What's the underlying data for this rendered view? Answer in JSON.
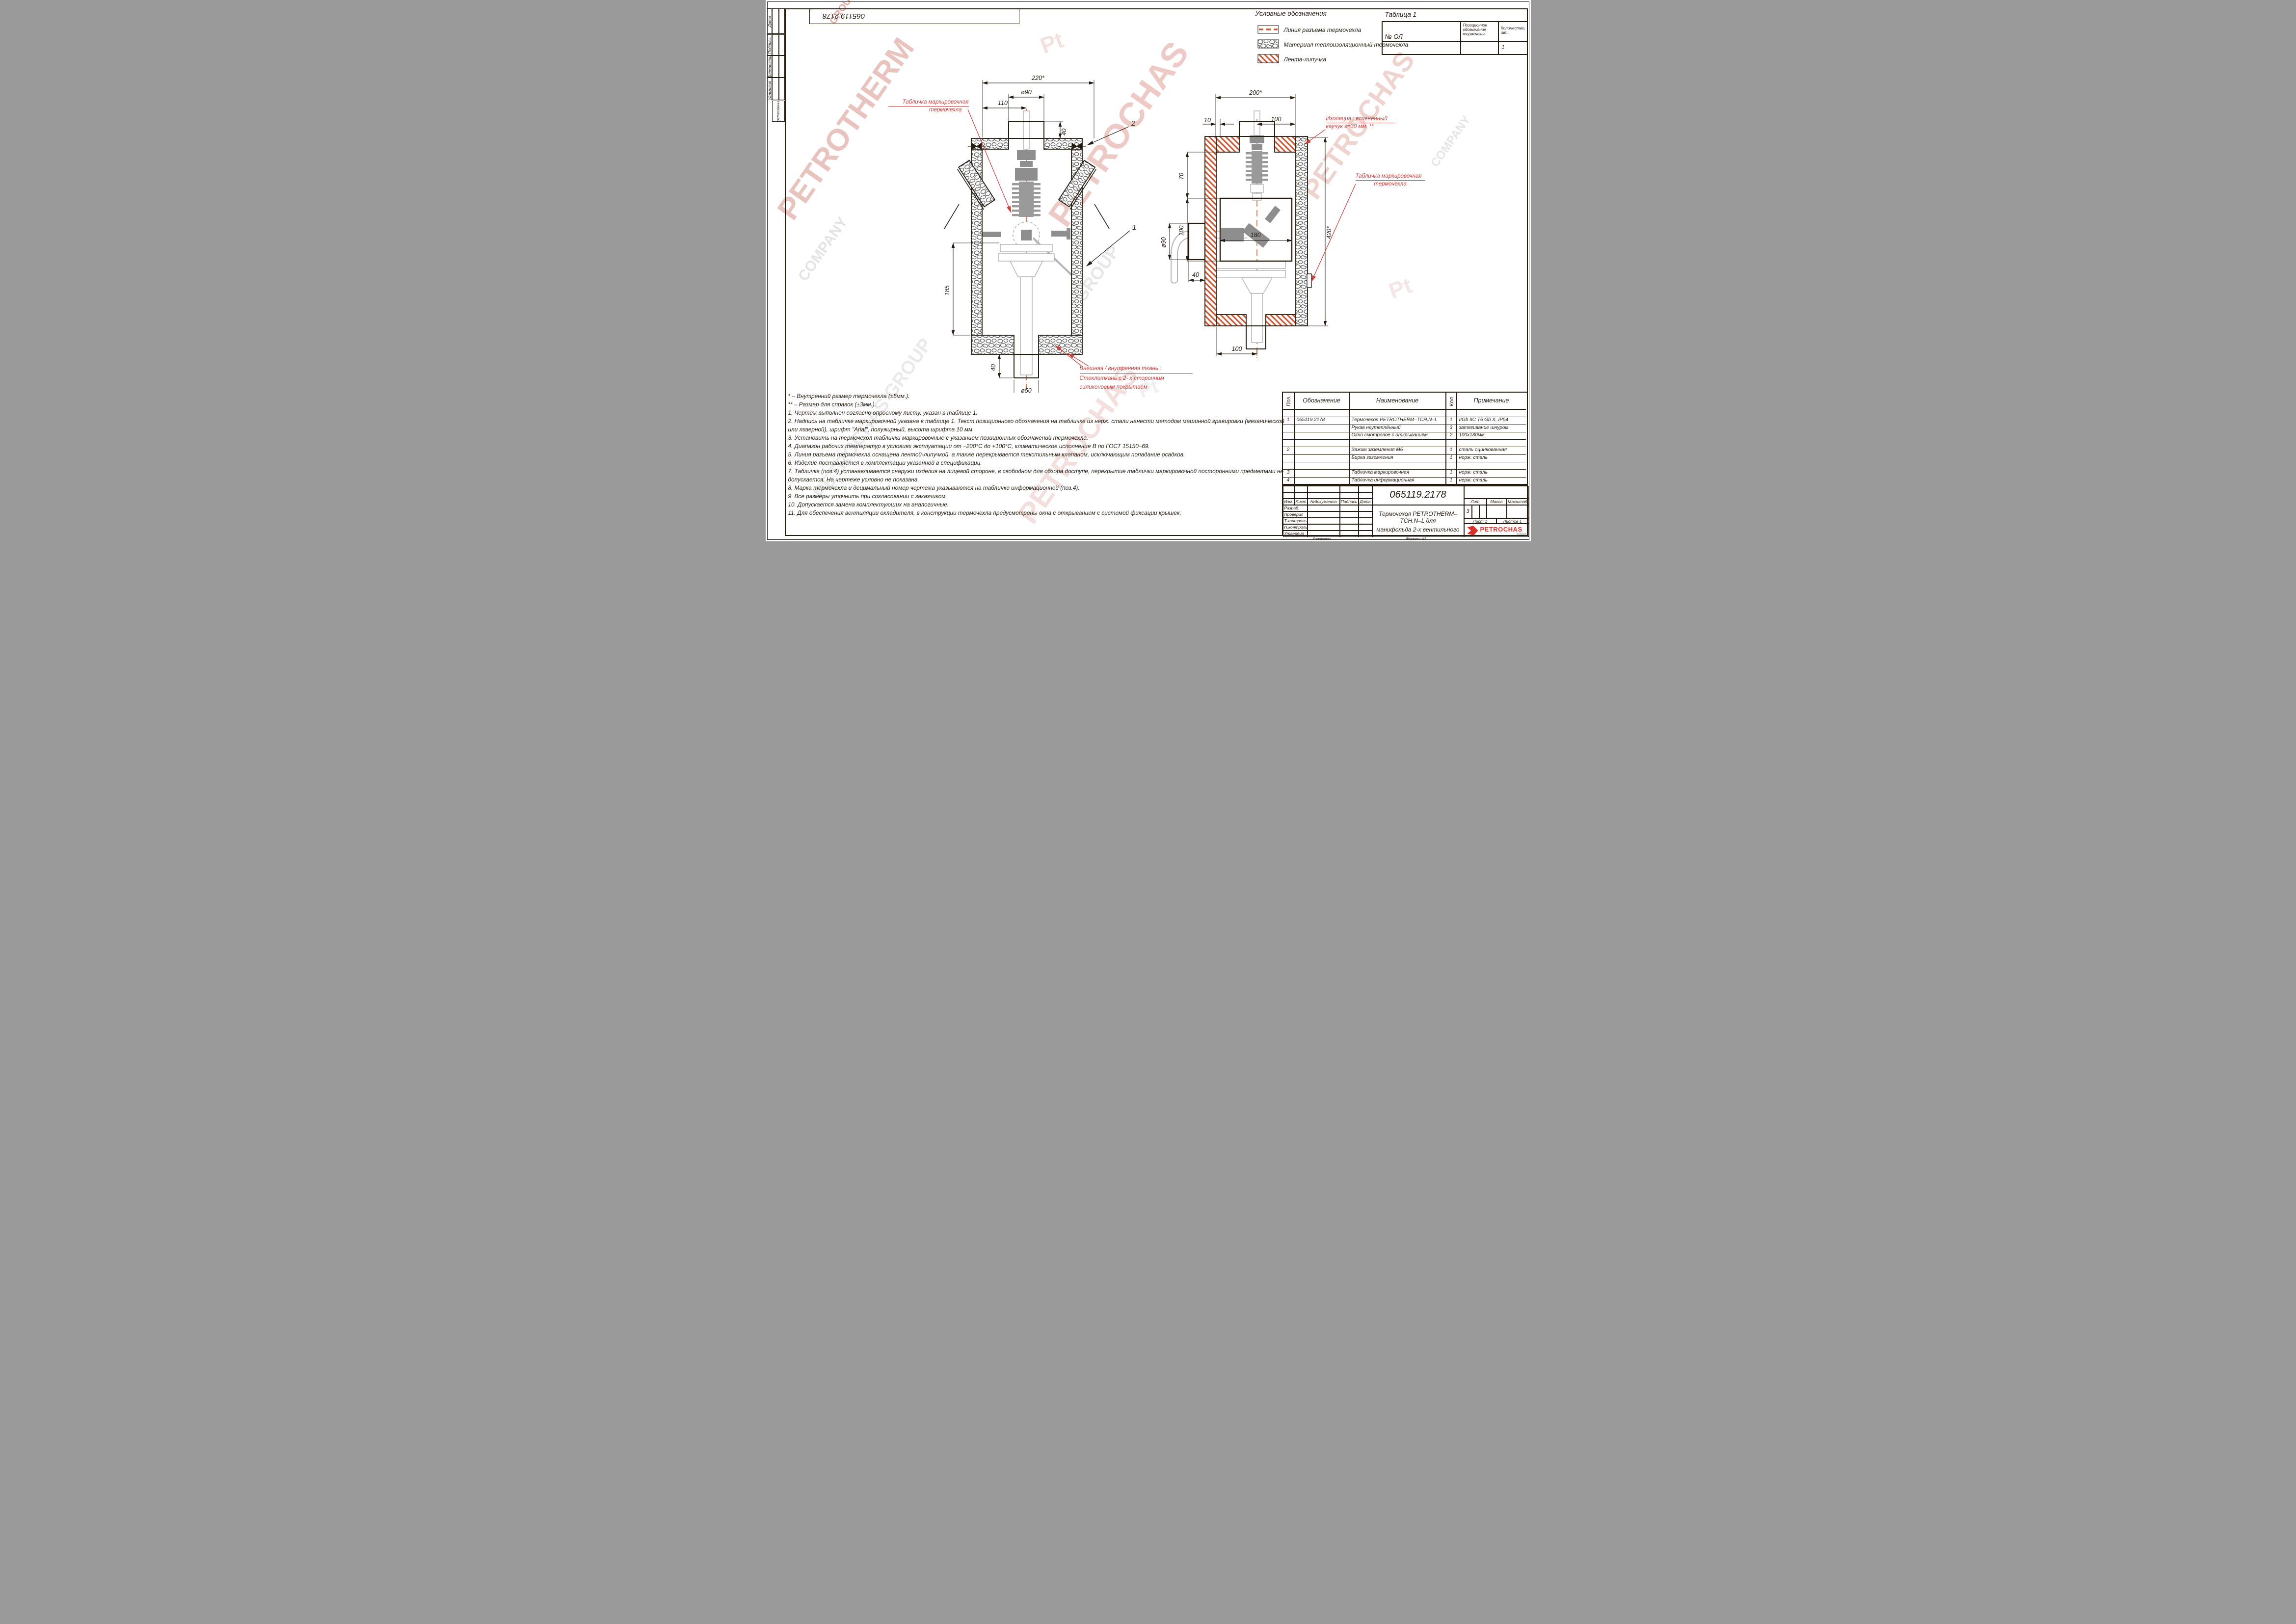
{
  "sheet": {
    "doc_number_top": "065119.2178",
    "copied_label": "Копировал",
    "format_label": "Формат А2"
  },
  "sidebar": {
    "labels": [
      "Дата",
      "Подпись",
      "Должность",
      "Фамилия",
      "Согласование"
    ]
  },
  "legend": {
    "title": "Условные обозначения",
    "items": [
      {
        "icon": "parting-line-swatch",
        "label": "Линия разъема термочехла"
      },
      {
        "icon": "insulation-swatch",
        "label": "Материал теплоизоляционный термочехла"
      },
      {
        "icon": "velcro-swatch",
        "label": "Лента-липучка"
      }
    ]
  },
  "table1": {
    "title": "Таблица 1",
    "col_ol": "№ ОЛ",
    "col_pos": [
      "Позиционное",
      "обозначение",
      "термочехла"
    ],
    "col_qty": [
      "Количество,",
      "шт."
    ],
    "row_qty": "1"
  },
  "left_view": {
    "dims": {
      "w220": "220*",
      "d90": "ø90",
      "w110": "110",
      "h40": "40",
      "h185": "185",
      "h40b": "40",
      "d50": "ø50"
    },
    "callout1": "1",
    "callout2": "2",
    "marking_label": [
      "Табличка маркировочная",
      "термочехла"
    ],
    "fabric_label": [
      "Внешняя / внутренняя ткань :",
      "Стеклоткань с  2- х сторонним",
      "силиконовым покрытием"
    ]
  },
  "right_view": {
    "dims": {
      "w200": "200*",
      "w10": "10",
      "w100": "100",
      "h70": "70",
      "h100": "100",
      "w180": "180",
      "d90": "ø90",
      "w40": "40",
      "h420": "420*",
      "w100b": "100"
    },
    "insulation_label": [
      "Изоляция : вспененный",
      "каучук  s=30 мм. **"
    ],
    "marking_label": [
      "Табличка маркировочная",
      "термочехла"
    ]
  },
  "notes": {
    "lines": [
      "* – Внутренний размер термочехла (±5мм.).",
      "** – Размер для справок (±3мм.).",
      "1. Чертёж выполнен согласно опросному листу, указан в таблице 1.",
      "2. Надпись на табличке маркировочной указана в таблице 1. Текст позиционного обозначения на табличке из нерж. стали нанести методом машинной гравировки (механической",
      "или лазерной), шрифт \"Arial\", полужирный, высота шрифта 10 мм",
      "3. Установить на термочехол таблички маркировочные с указанием позиционных обозначений термочехла.",
      "4. Диапазон рабочих температур в условиях эксплуатации от –200°С до +100°С, климатическое исполнение В по ГОСТ 15150–69.",
      "5. Линия разъема термочехла оснащена лентой-липучкой, а также перекрывается текстильным клапаном, исключающим попадание осадков.",
      "6. Изделие поставляется в комплектации указанной в спецификации.",
      "7. Табличка (поз.4) устанавливается снаружи изделия на лицевой стороне, в свободном для обзора доступе, перекрытие таблички маркировочной посторонними предметами не",
      "допускается. На чертеже условно не показана.",
      "8. Марка термочехла и децимальный номер чертежа указываются на табличке информационной (поз.4).",
      "9. Все размеры уточнить при согласовании с заказчиком.",
      "10. Допускается замена комплектующих на аналогичные.",
      "11. Для обеспечения вентиляции охладителя, в конструкции термочехла предусмотрены окна с открыванием с системой фиксации крышек."
    ]
  },
  "spec_table": {
    "headers": {
      "pos": "Поз.",
      "designation": "Обозначение",
      "name": "Наименование",
      "qty": "Кол.",
      "note": "Примечание"
    },
    "rows": [
      {
        "pos": "",
        "designation": "",
        "name": "",
        "qty": "",
        "note": ""
      },
      {
        "pos": "1",
        "designation": "065119.2178",
        "name": "Термочехол PETROTHERM–TCH.N–L",
        "qty": "1",
        "note": "IIGb IIC T6 Gb X, IP54"
      },
      {
        "pos": "",
        "designation": "",
        "name": "Рукав неутеплённый",
        "qty": "3",
        "note": "затягивание шнуром"
      },
      {
        "pos": "",
        "designation": "",
        "name": "Окно смотровое с открыванием",
        "qty": "2",
        "note": "100х180мм."
      },
      {
        "pos": "",
        "designation": "",
        "name": "",
        "qty": "",
        "note": ""
      },
      {
        "pos": "2",
        "designation": "",
        "name": "Зажим заземления М6",
        "qty": "1",
        "note": "сталь оцинкованная"
      },
      {
        "pos": "",
        "designation": "",
        "name": "Бирка заземления",
        "qty": "1",
        "note": "нерж. сталь"
      },
      {
        "pos": "",
        "designation": "",
        "name": "",
        "qty": "",
        "note": ""
      },
      {
        "pos": "3",
        "designation": "",
        "name": "Табличка маркировочная",
        "qty": "1",
        "note": "нерж. сталь"
      },
      {
        "pos": "4",
        "designation": "",
        "name": "Табличка информационная",
        "qty": "1",
        "note": "нерж. сталь"
      }
    ]
  },
  "title_block": {
    "doc_number": "065119.2178",
    "change_cols": [
      "Изм.",
      "Лист",
      "№документа",
      "Подпись",
      "Дата"
    ],
    "role_rows": [
      "Разраб.",
      "Проверил",
      "Т.контроль",
      "Н.контроль",
      "Утвердил"
    ],
    "title_lines": [
      "Термочехол PETROTHERM–TCH.N–L для",
      "манифольда 2-х вентильного"
    ],
    "lit": "Лит",
    "mass": "Масса",
    "scale": "Масштаб",
    "lit_value": "3",
    "sheet": "Лист 1",
    "sheets": "Листов 1",
    "logo": "PETROCHAS",
    "logo_sub": "ЗАВОД"
  },
  "watermarks": {
    "w_petrotherm": "PETROTHERM",
    "w_petrochas": "PETROCHAS",
    "w_group": "GROUP",
    "w_company": "COMPANY",
    "w_pg": "PETROCHAS GROUP",
    "w_pt": "Pt"
  }
}
